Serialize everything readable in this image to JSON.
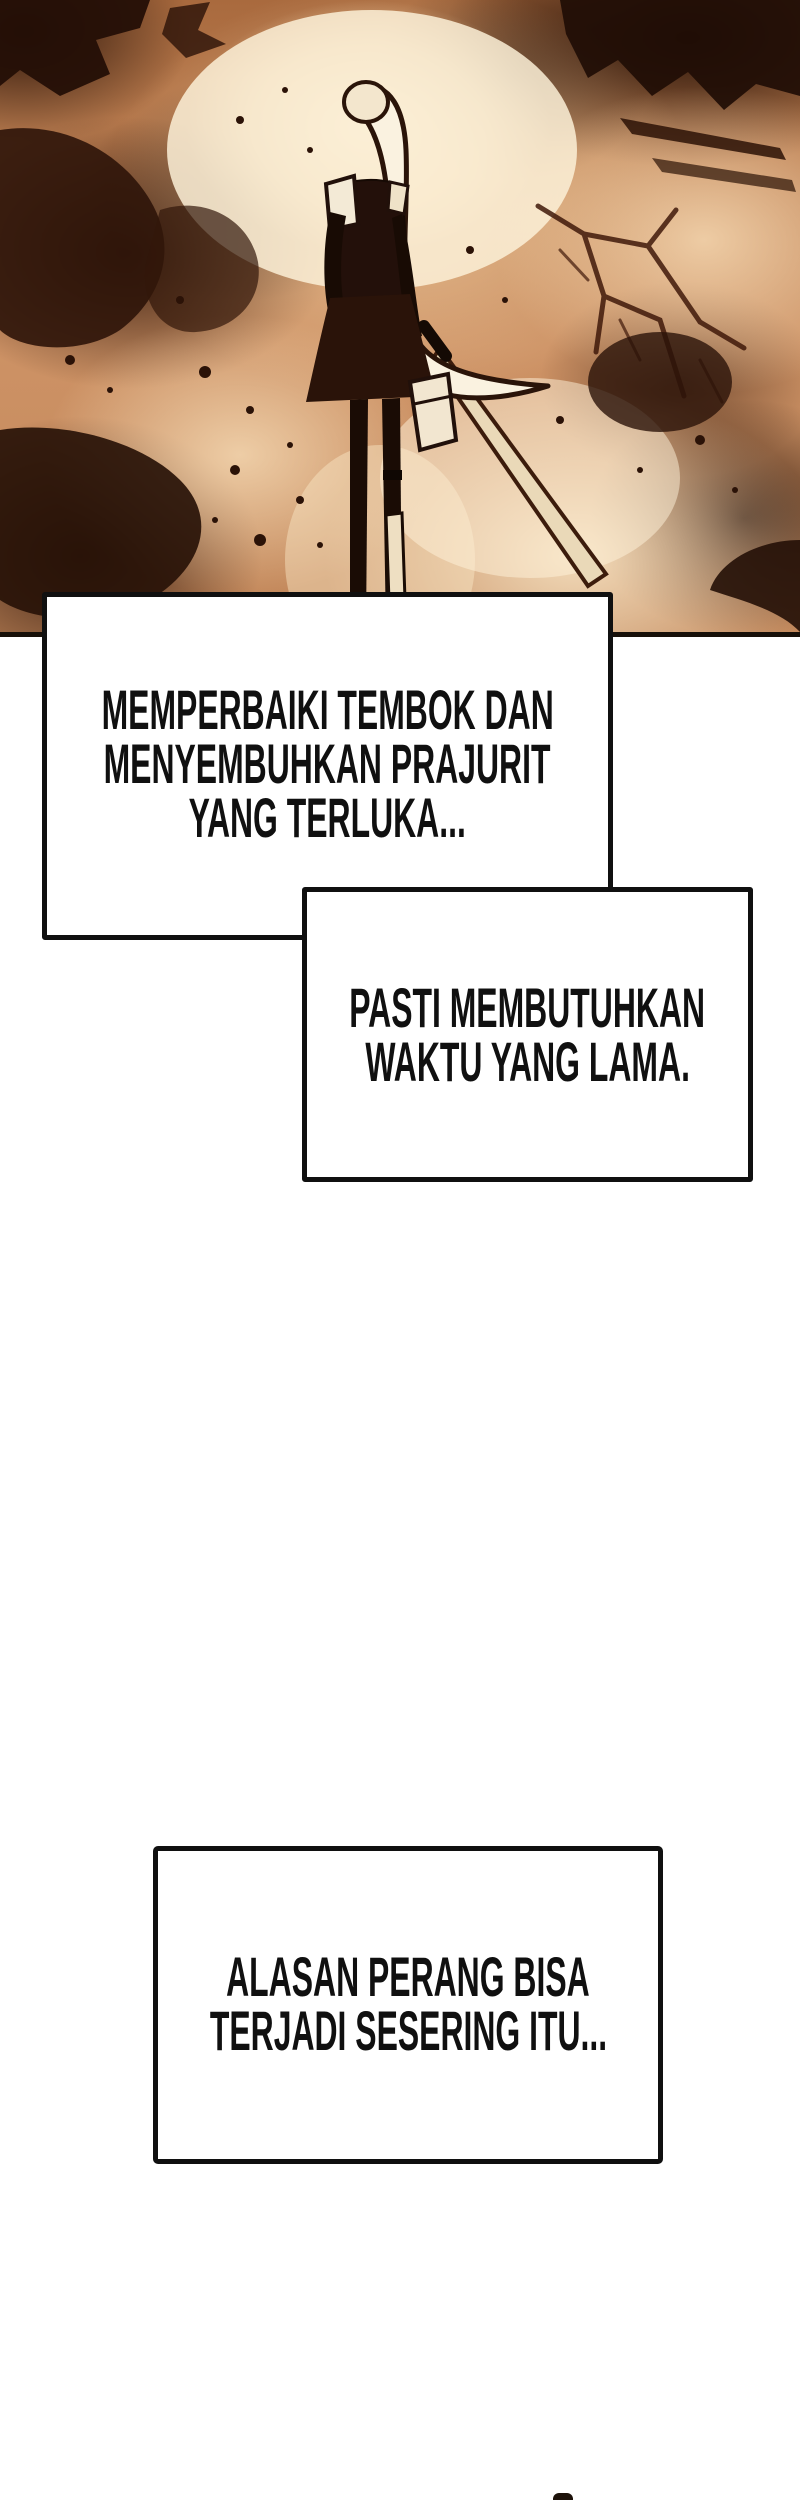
{
  "page": {
    "kind": "webtoon comic page",
    "background_color": "#ffffff",
    "outline_color": "#101010",
    "text_color": "#101010"
  },
  "artwork": {
    "description": "sepia monochrome panel: long-ponytailed swordsman seen from behind standing on cracked scorched ground",
    "palette": {
      "base": "#b87849",
      "highlight": "#f8ecd4",
      "midtone": "#c98d5e",
      "shadow": "#2b1207"
    }
  },
  "bubbles": [
    {
      "id": "bubble-1",
      "lines": [
        "MEMPERBAIKI TEMBOK DAN",
        "MENYEMBUHKAN PRAJURIT",
        "YANG TERLUKA..."
      ]
    },
    {
      "id": "bubble-2",
      "lines": [
        "PASTI MEMBUTUHKAN",
        "WAKTU YANG LAMA."
      ]
    },
    {
      "id": "bubble-3",
      "lines": [
        "ALASAN PERANG BISA",
        "TERJADI SESERING ITU..."
      ]
    }
  ]
}
